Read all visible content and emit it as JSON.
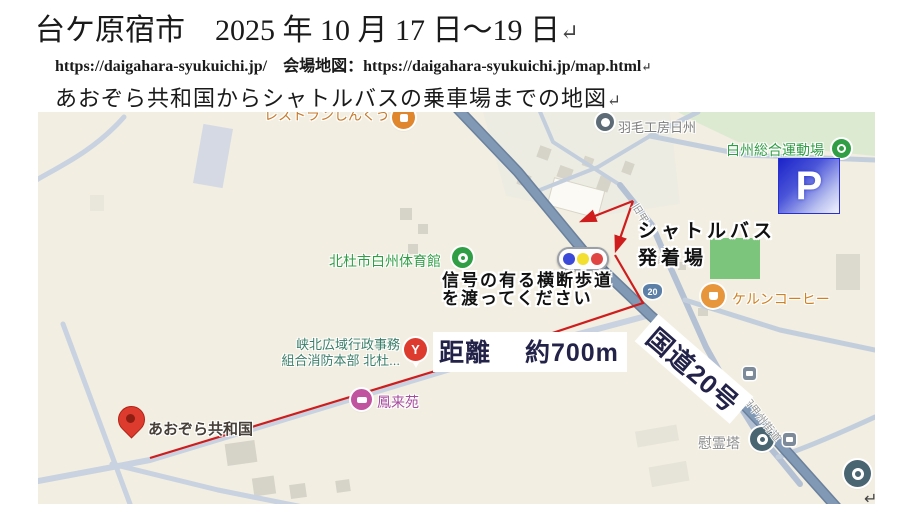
{
  "page": {
    "return_mark": "↵"
  },
  "header": {
    "title": "台ケ原宿市　2025 年 10 月 17 日～19 日",
    "url1": "https://daigahara-syukuichi.jp/",
    "venue_label": "　会場地図：",
    "url2": "https://daigahara-syukuichi.jp/map.html",
    "subtitle": "あおぞら共和国からシャトルバスの乗車場までの地図"
  },
  "map": {
    "pois": {
      "restaurant": "レストランしんくう",
      "feather_workshop": "羽毛工房日州",
      "sports_ground": "白州総合運動場",
      "gymnasium": "北杜市白州体育館",
      "coffee": "ケルンコーヒー",
      "fire_dept_line1": "峡北広域行政事務",
      "fire_dept_line2": "組合消防本部 北杜...",
      "fire_dept_glyph": "Y",
      "lodging": "鳳来苑",
      "aozora": "あおぞら共和国",
      "memorial": "慰霊塔"
    },
    "roads": {
      "route20_shield": "20",
      "old_road_short": "旧甲",
      "old_road": "旧甲州街道"
    },
    "annotations": {
      "shuttle_line1": "シャトルバス",
      "shuttle_line2": "発着場",
      "signal_line1": "信号の有る横断歩道",
      "signal_line2": "を渡ってください",
      "distance": "距離　 約700m",
      "route20": "国道20号",
      "parking": "P"
    },
    "colors": {
      "map_background": "#f2eee1",
      "route_line_red": "#cf1d1d",
      "main_road": "#7d94b0",
      "minor_road": "#c8d2e0",
      "park_green": "#7cc57c",
      "parking_blue": "#1b23c9",
      "poi_green": "#2f9e44",
      "poi_orange": "#c8792a",
      "annotation_text": "#23234a",
      "signal_blue": "#3b49d8",
      "signal_yellow": "#f2df2f",
      "signal_red": "#e04543"
    }
  }
}
